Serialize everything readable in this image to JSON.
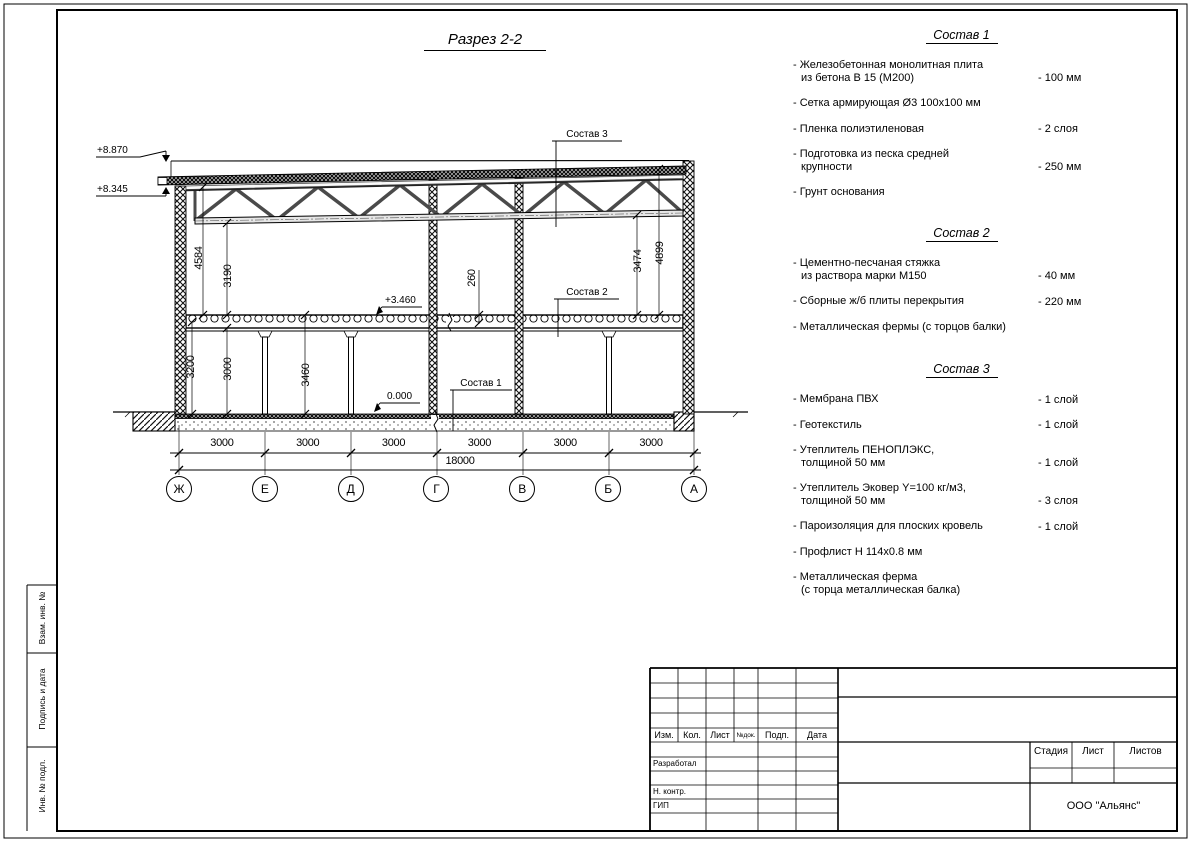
{
  "page": {
    "title_label": "Разрез 2-2"
  },
  "drawing": {
    "levels": {
      "parapet": "+8.870",
      "roof": "+8.345",
      "floor2": "+3.460",
      "floor1": "0.000"
    },
    "dims": {
      "left_outer": "4584",
      "left_inner": "3190",
      "right_inner": "3474",
      "right_outer": "4899",
      "f1_left_a": "3200",
      "f1_left_b": "3000",
      "f1_mid": "3460",
      "slab": "260",
      "total": "18000"
    },
    "spans": [
      "3000",
      "3000",
      "3000",
      "3000",
      "3000",
      "3000"
    ],
    "axes": [
      "Ж",
      "Е",
      "Д",
      "Г",
      "В",
      "Б",
      "А"
    ],
    "callouts": {
      "c1": "Состав 1",
      "c2": "Состав 2",
      "c3": "Состав 3"
    }
  },
  "compositions": [
    {
      "title": "Состав 1",
      "items": [
        {
          "text": "- Железобетонная  монолитная плита\nиз бетона В 15 (М200)",
          "value": "- 100 мм"
        },
        {
          "text": "- Сетка армирующая Ø3 100х100 мм",
          "value": ""
        },
        {
          "text": "- Пленка полиэтиленовая",
          "value": "-  2 слоя"
        },
        {
          "text": "- Подготовка из песка средней\nкрупности",
          "value": "- 250 мм"
        },
        {
          "text": "- Грунт основания",
          "value": ""
        }
      ]
    },
    {
      "title": "Состав 2",
      "items": [
        {
          "text": "- Цементно-песчаная стяжка\nиз раствора марки М150",
          "value": "- 40 мм"
        },
        {
          "text": "- Сборные ж/б плиты перекрытия",
          "value": "- 220 мм"
        },
        {
          "text": "- Металлическая фермы (с торцов балки)",
          "value": ""
        }
      ]
    },
    {
      "title": "Состав 3",
      "items": [
        {
          "text": "- Мембрана ПВХ",
          "value": "- 1 слой"
        },
        {
          "text": "- Геотекстиль",
          "value": "- 1 слой"
        },
        {
          "text": "- Утеплитель ПЕНОПЛЭКС,\nтолщиной 50 мм",
          "value": "- 1 слой"
        },
        {
          "text": "- Утеплитель Эковер Y=100 кг/м3,\nтолщиной 50 мм",
          "value": "- 3 слоя"
        },
        {
          "text": "- Пароизоляция для плоских кровель",
          "value": "- 1 слой"
        },
        {
          "text": "- Профлист Н 114х0.8 мм",
          "value": ""
        },
        {
          "text": "- Металлическая ферма\n(с торца металлическая балка)",
          "value": ""
        }
      ]
    }
  ],
  "titleblock": {
    "header_cols": [
      "Изм.",
      "Кол.",
      "Лист",
      "№док.",
      "Подп.",
      "Дата"
    ],
    "role_rows": [
      "Разработал",
      "Н. контр.",
      "ГИП"
    ],
    "stage_cols": [
      "Стадия",
      "Лист",
      "Листов"
    ],
    "company": "ООО \"Альянс\""
  },
  "margin_strip": [
    "Взам. инв. №",
    "Подпись и дата",
    "Инв. № подл."
  ]
}
